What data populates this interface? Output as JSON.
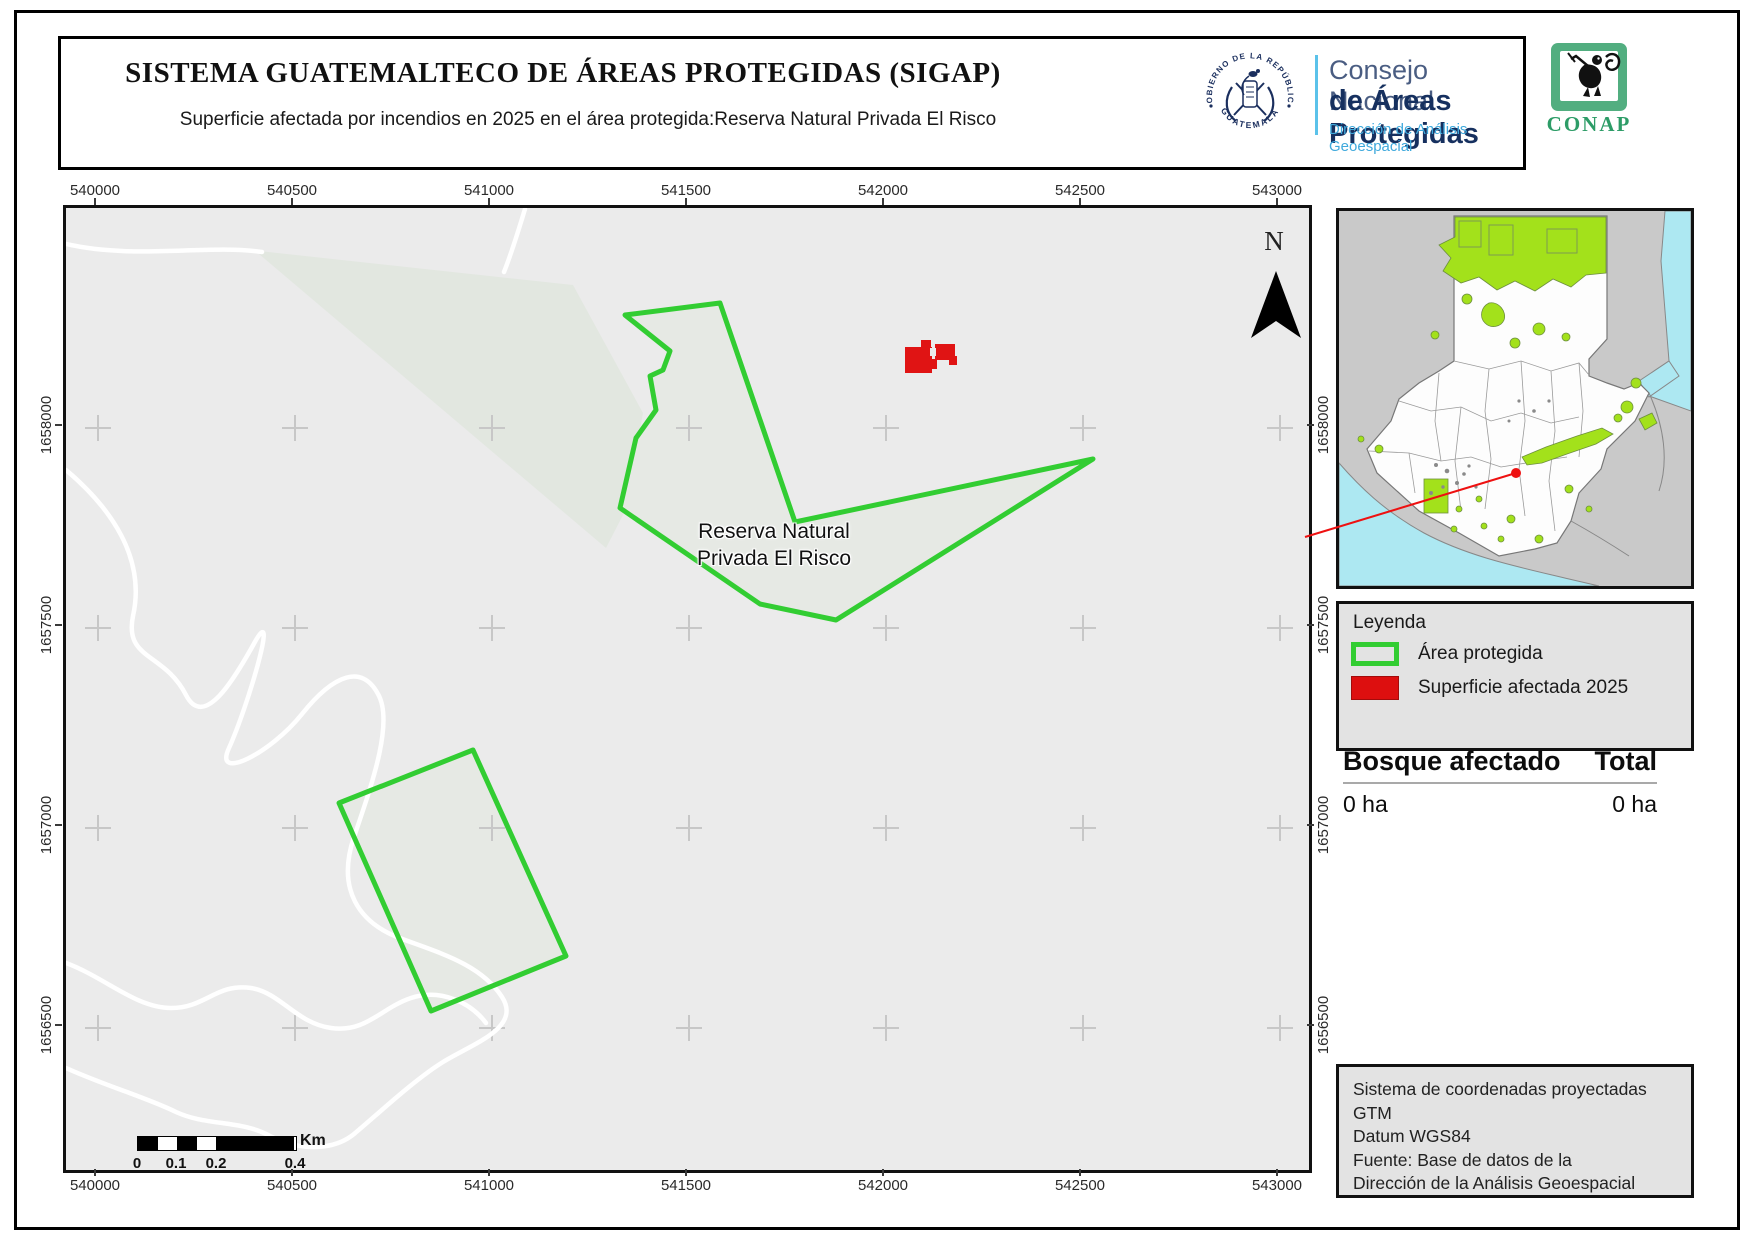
{
  "header": {
    "title": "SISTEMA GUATEMALTECO DE ÁREAS PROTEGIDAS  (SIGAP)",
    "subtitle": "Superficie afectada por incendios en 2025 en el área protegida:Reserva Natural Privada El Risco",
    "seal": {
      "arc_top": "GOBIERNO DE LA REPÚBLICA",
      "arc_bottom": "GUATEMALA"
    },
    "wordmark": {
      "line1": "Consejo Nacional",
      "line2": "de Áreas Protegidas",
      "line3": "Dirección de Análisis Geoespacial"
    },
    "conap": "CONAP"
  },
  "map": {
    "x_ticks": [
      "540000",
      "540500",
      "541000",
      "541500",
      "542000",
      "542500",
      "543000"
    ],
    "y_ticks": [
      "1658000",
      "1657500",
      "1657000",
      "1656500"
    ],
    "north": "N",
    "area_label": {
      "line1": "Reserva Natural",
      "line2": "Privada El Risco"
    },
    "scalebar": {
      "t0": "0",
      "t1": "0.1",
      "t2": "0.2",
      "t3": "0.4",
      "unit": "Km"
    }
  },
  "legend": {
    "title": "Leyenda",
    "items": [
      {
        "label": "Área protegida",
        "type": "outline",
        "color": "#32cd32"
      },
      {
        "label": "Superficie afectada 2025",
        "type": "fill",
        "color": "#dd0f0f"
      }
    ]
  },
  "stats": {
    "col1_header": "Bosque afectado",
    "col2_header": "Total",
    "col1_value": "0 ha",
    "col2_value": "0 ha"
  },
  "source_box": {
    "line1": "Sistema de coordenadas proyectadas",
    "line2": "GTM",
    "line3": "Datum WGS84",
    "line4": "Fuente: Base de datos de la",
    "line5": "Dirección de la Análisis Geoespacial"
  },
  "colors": {
    "protected_outline": "#32cd32",
    "protected_fill": "#e6e9e4",
    "affected_fill": "#e01414",
    "map_background": "#ebebeb",
    "inset_protected": "#a3e11b",
    "water": "#ade8f2",
    "neighbor_gray": "#c9c9c9"
  }
}
